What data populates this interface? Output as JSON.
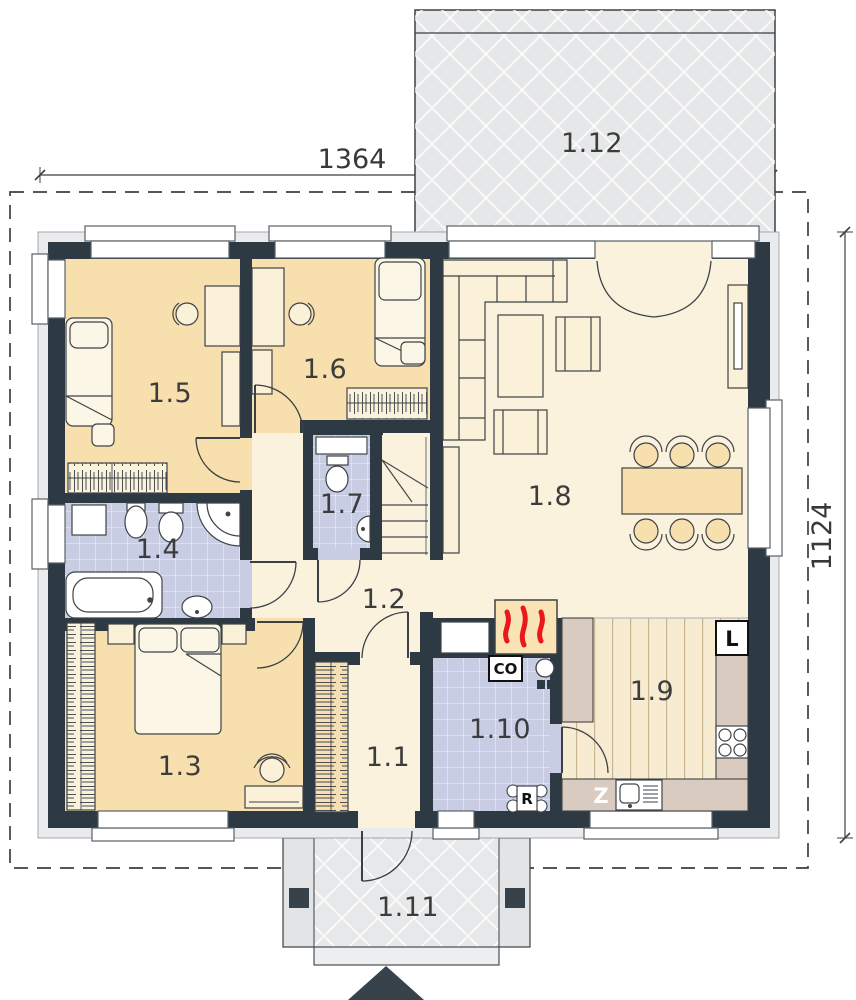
{
  "dimensions": {
    "top_width": "1364",
    "right_height": "1124"
  },
  "room_labels": {
    "entry_hall": "1.1",
    "hall": "1.2",
    "bedroom_master": "1.3",
    "bathroom": "1.4",
    "bedroom_left": "1.5",
    "bedroom_middle": "1.6",
    "wc": "1.7",
    "living_room": "1.8",
    "kitchen": "1.9",
    "utility_room": "1.10",
    "entrance_porch": "1.11",
    "terrace": "1.12"
  },
  "equipment_labels": {
    "central_heating_boiler": "CO",
    "fridge": "L",
    "kitchen_sink_counter": "Z",
    "heating_manifold": "R"
  },
  "colors": {
    "wall": "#2E3A43",
    "bedroom_floor": "#F8DFAE",
    "hall_floor": "#FBF2DD",
    "tile_floor": "#C9CDE3",
    "wood_floor": "#F7ECD2",
    "counter": "#D9CBBF",
    "paving": "#E6E7E8",
    "flame_red": "#E8191B"
  }
}
